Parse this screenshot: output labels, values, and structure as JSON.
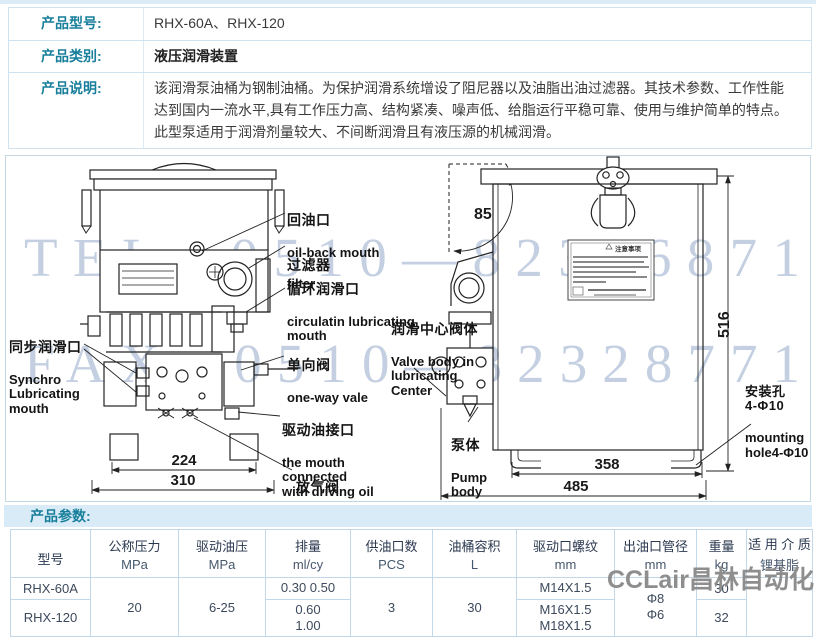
{
  "info_rows": [
    {
      "label": "产品型号:",
      "value": "RHX-60A、RHX-120"
    },
    {
      "label": "产品类别:",
      "value": "液压润滑装置"
    },
    {
      "label": "产品说明:",
      "value": "该润滑泵油桶为钢制油桶。为保护润滑系统增设了阻尼器以及油脂出油过滤器。其技术参数、工作性能达到国内一流水平,具有工作压力高、结构紧凑、噪声低、给脂运行平稳可靠、使用与维护简单的特点。此型泵适用于润滑剂量较大、不间断润滑且有液压源的机械润滑。"
    }
  ],
  "diagram": {
    "watermarks": {
      "tel": "TEL: 0510—82306871",
      "fax": "FAX: 0510—82328771",
      "vendor": "CCLair昌林自动化"
    },
    "plate_title": "注意事项",
    "labels": {
      "oil_back": {
        "cn": "回油口",
        "en": "oil-back mouth"
      },
      "filter": {
        "cn": "过滤器",
        "en": "filter"
      },
      "circulating": {
        "cn": "循环润滑口",
        "en": "circulatin lubricating\nmouth"
      },
      "valve_center": {
        "cn": "润滑中心阀体",
        "en": "Valve body in\nlubricating\nCenter"
      },
      "one_way": {
        "cn": "单向阀",
        "en": "one-way vale"
      },
      "synchro": {
        "cn": "同步润滑口",
        "en": "Synchro\nLubricating\nmouth"
      },
      "driving_oil": {
        "cn": "驱动油接口",
        "en": "the mouth\nconnected\nwith driving oil"
      },
      "air_vent": {
        "cn": "放气阀",
        "en": "air vent valve"
      },
      "pump_body": {
        "cn": "泵体",
        "en": "Pump\nbody"
      },
      "mounting": {
        "cn": "安装孔\n4-Φ10",
        "en": "mounting\nhole4-Φ10"
      }
    },
    "dimensions": {
      "front_inner": "224",
      "front_total": "310",
      "side_inner": "358",
      "side_total": "485",
      "height": "516",
      "lid_angle": "85"
    }
  },
  "params": {
    "section_label": "产品参数:",
    "headers": [
      {
        "name": "型号",
        "unit": ""
      },
      {
        "name": "公称压力",
        "unit": "MPa"
      },
      {
        "name": "驱动油压",
        "unit": "MPa"
      },
      {
        "name": "排量",
        "unit": "ml/cy"
      },
      {
        "name": "供油口数",
        "unit": "PCS"
      },
      {
        "name": "油桶容积",
        "unit": "L"
      },
      {
        "name": "驱动口螺纹",
        "unit": "mm"
      },
      {
        "name": "出油口管径",
        "unit": "mm"
      },
      {
        "name": "重量",
        "unit": "kg"
      },
      {
        "name": "适 用 介 质",
        "unit": "锂基脂"
      }
    ],
    "shared": {
      "nominal_pressure": "20",
      "driving_pressure": "6-25",
      "oil_ports": "3",
      "barrel_volume": "30",
      "outlet_diameter": "Φ8\nΦ6",
      "medium": ""
    },
    "rows": [
      {
        "model": "RHX-60A",
        "displacement": "0.30 0.50",
        "thread": "M14X1.5",
        "weight": "30"
      },
      {
        "model": "RHX-120",
        "displacement": "0.60\n1.00",
        "thread": "M16X1.5\nM18X1.5",
        "weight": "32"
      }
    ]
  }
}
